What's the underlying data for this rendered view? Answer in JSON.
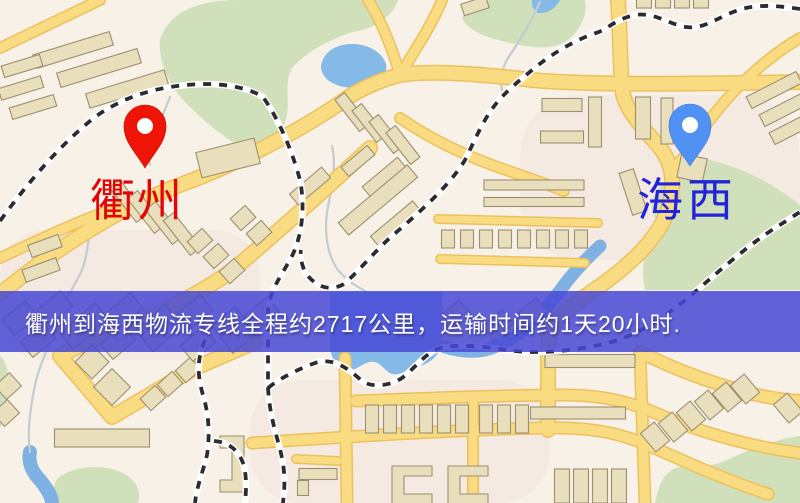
{
  "map": {
    "origin": {
      "name": "衢州"
    },
    "destination": {
      "name": "海西"
    },
    "banner": {
      "text": "衢州到海西物流专线全程约2717公里，运输时间约1天20小时."
    }
  },
  "theme": {
    "background": "#f7f1e7",
    "banner-bg": "rgba(70,72,213,0.85)",
    "banner-text": "#ffffff",
    "origin-pin": "#ee1506",
    "origin-label": "#e30505",
    "dest-pin": "#4f92f4",
    "dest-label": "#2323d9",
    "road-fill": "#f9dc82",
    "road-casing": "#edc05e",
    "railway-dark": "#2b2b31",
    "water": "#85b9e8",
    "river": "#7fb2e2",
    "park": "#d0e0ba",
    "building-fill": "#eadfbd",
    "building-stroke": "#9b8f6f",
    "stream": "#c2ccd1"
  }
}
